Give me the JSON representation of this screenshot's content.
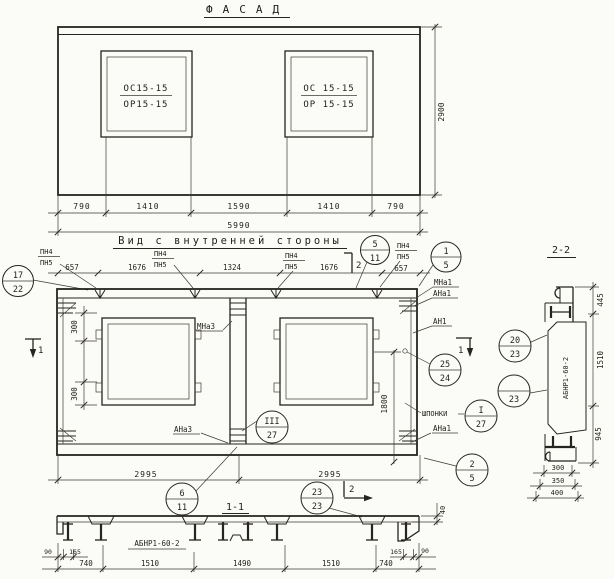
{
  "sheet": {
    "bg": "#fbfbf8",
    "ink": "#26241e"
  },
  "facade": {
    "title": "ФАСАД",
    "window1": {
      "top": "ОС15-15",
      "bottom": "ОР15-15"
    },
    "window2": {
      "top": "ОС 15-15",
      "bottom": "ОР 15-15"
    },
    "dim_height": "2900",
    "dims": [
      "790",
      "1410",
      "1590",
      "1410",
      "790"
    ],
    "dim_total": "5990"
  },
  "inner": {
    "title": "Вид с внутренней стороны",
    "pn": {
      "top": "ПН4",
      "bottom": "ПН5"
    },
    "top_dims": [
      "657",
      "1676",
      "1324",
      "1676",
      "657"
    ],
    "left_dims": [
      "300",
      "300"
    ],
    "dim_vertical": "1800",
    "bottom_dims": [
      "2995",
      "2995"
    ],
    "labels": {
      "mna3": "МНа3",
      "ana3": "АНа3",
      "mna1": "МНа1",
      "ana1_top": "АНа1",
      "an1": "АН1",
      "shponki": "ШПОНКИ",
      "ana1_bottom": "АНа1"
    },
    "section_marks": {
      "s1": "1",
      "s2": "2"
    }
  },
  "balloons": {
    "b5_11": {
      "top": "5",
      "bottom": "11"
    },
    "b1_5": {
      "top": "1",
      "bottom": "5"
    },
    "b17_22": {
      "top": "17",
      "bottom": "22"
    },
    "b25_24": {
      "top": "25",
      "bottom": "24"
    },
    "b20_23": {
      "top": "20",
      "bottom": "23"
    },
    "b22_23": {
      "top": "22",
      "bottom": "23"
    },
    "bI_27": {
      "top": "I",
      "bottom": "27"
    },
    "bIII_27": {
      "top": "III",
      "bottom": "27"
    },
    "b6_11": {
      "top": "6",
      "bottom": "11"
    },
    "b23_23": {
      "top": "23",
      "bottom": "23"
    },
    "b2_5": {
      "top": "2",
      "bottom": "5"
    }
  },
  "section11": {
    "title": "1-1",
    "panel_mark": "АБНР1-60-2",
    "edge_dims_left": [
      "90",
      "165"
    ],
    "edge_dims_right": [
      "165",
      "90"
    ],
    "dims": [
      "740",
      "1510",
      "1490",
      "1510",
      "740"
    ],
    "dim_thickness": "40"
  },
  "section22": {
    "title": "2-2",
    "panel_mark": "АБНР1-60-2",
    "right_dims": [
      "445",
      "1510",
      "945"
    ],
    "bottom_dims": [
      "300",
      "350",
      "400"
    ]
  }
}
